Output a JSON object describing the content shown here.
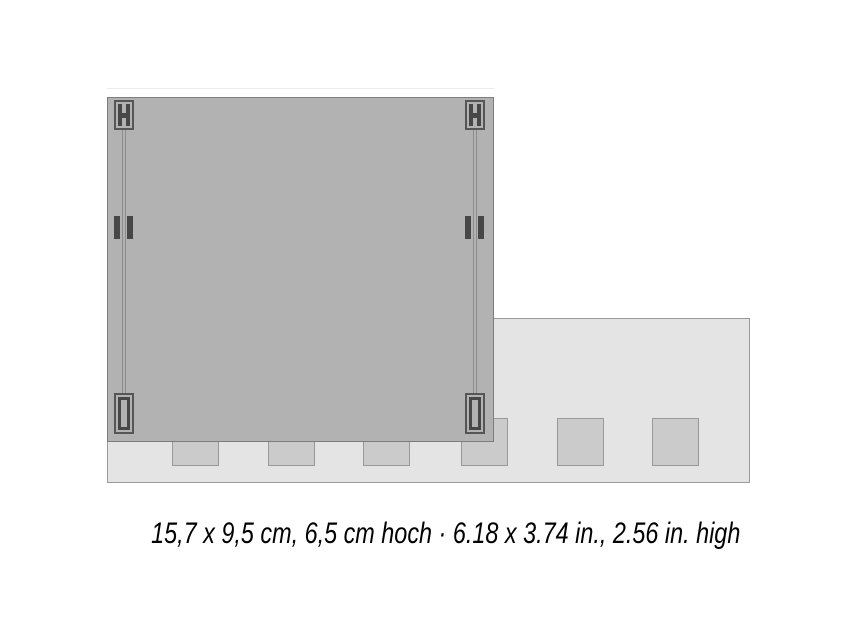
{
  "caption": {
    "text": "15,7 x 9,5 cm, 6,5 cm hoch · 6.18 x 3.74 in., 2.56 in. high"
  },
  "diagram": {
    "tab_positions_px": [
      172,
      268,
      363,
      461,
      557,
      652
    ]
  },
  "colors": {
    "background": "#ffffff",
    "plate_fill": "#b2b2b2",
    "plate_outline": "#7d7d7d",
    "strip_fill": "#e4e4e4",
    "strip_outline": "#9a9a9a",
    "tab_fill": "#cbcbcb",
    "tab_outline": "#999999",
    "detail_fill": "#474747",
    "detail_outline": "#565656",
    "fold_line": "#8c8c8c",
    "text": "#000000"
  }
}
